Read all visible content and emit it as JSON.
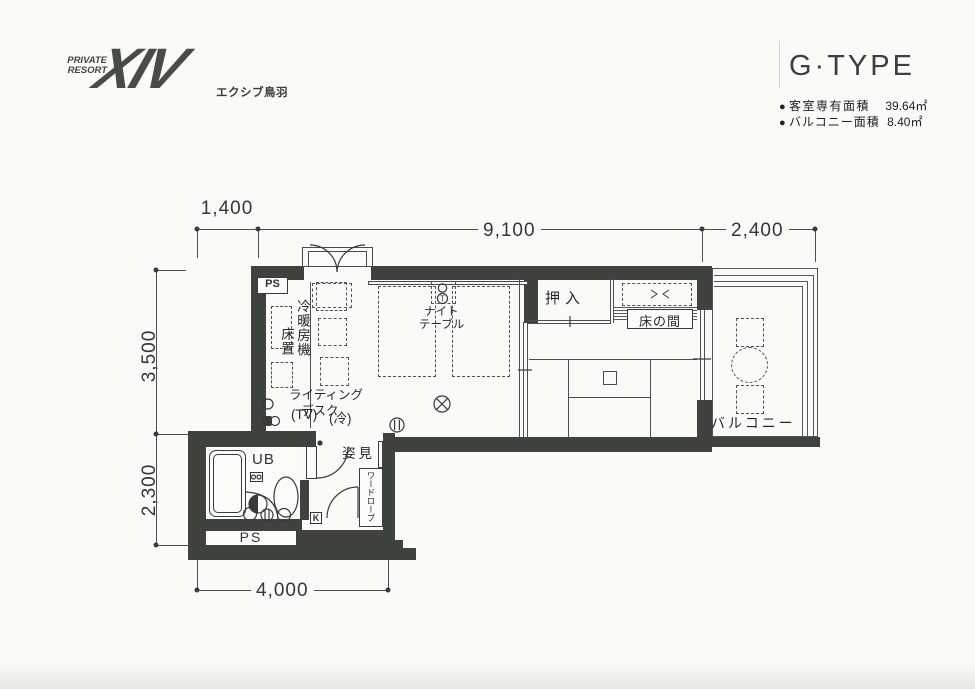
{
  "brand": {
    "line1": "PRIVATE",
    "line2": "RESORT",
    "mark": "XIV",
    "name": "エクシブ鳥羽"
  },
  "title": {
    "type": "G·TYPE",
    "specs": [
      {
        "bullet": "●",
        "label": "客室専有面積",
        "value": "39.64㎡"
      },
      {
        "bullet": "●",
        "label": "バルコニー面積",
        "value": "8.40㎡"
      }
    ]
  },
  "dims": {
    "top_left": "1,400",
    "top_center": "9,100",
    "top_right": "2,400",
    "left_upper": "3,500",
    "left_lower": "2,300",
    "bottom": "4,000"
  },
  "labels": {
    "ps_top": "PS",
    "ac_unit": "冷暖房機",
    "ac_floor": "床置",
    "desk_line1": "ライティング",
    "desk_line2": "デスク",
    "tv": "(TV)",
    "fridge": "(冷)",
    "night_line1": "ナイト",
    "night_line2": "テーブル",
    "closet": "押入",
    "tokonoma": "床の間",
    "balcony": "バルコニー",
    "mirror": "姿見",
    "unit_bath": "UB",
    "wardrobe": "ワードローブ",
    "ps_bottom": "PS",
    "k_mark": "K",
    "tel_mark": "T"
  },
  "colors": {
    "wall": "#3e433e",
    "line": "#4e4e4e",
    "paper": "#fafaf6"
  }
}
